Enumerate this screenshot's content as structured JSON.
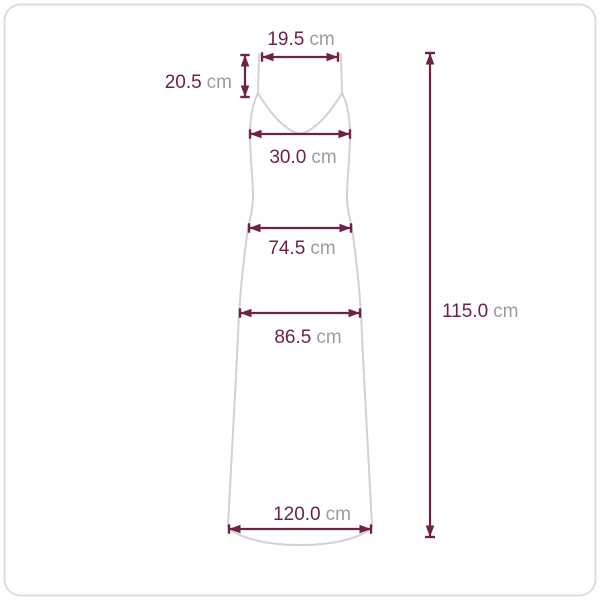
{
  "diagram": {
    "type": "garment-size-measurement",
    "garment": "sleeveless-maxi-slip-dress",
    "unit_default": "cm",
    "colors": {
      "dimension_line": "#6f2146",
      "value_text": "#6f2146",
      "unit_text": "#9c9c9c",
      "garment_outline": "#d2d2d2",
      "frame_border": "#dddddd",
      "background": "#ffffff"
    }
  },
  "measurements": [
    {
      "id": "strap-span",
      "value": "19.5",
      "unit": "cm",
      "orientation": "horizontal",
      "label_position": "above"
    },
    {
      "id": "strap-length",
      "value": "20.5",
      "unit": "cm",
      "orientation": "vertical",
      "label_position": "left"
    },
    {
      "id": "bust-width",
      "value": "30.0",
      "unit": "cm",
      "orientation": "horizontal",
      "label_position": "below"
    },
    {
      "id": "waist-width",
      "value": "74.5",
      "unit": "cm",
      "orientation": "horizontal",
      "label_position": "below"
    },
    {
      "id": "hip-width",
      "value": "86.5",
      "unit": "cm",
      "orientation": "horizontal",
      "label_position": "below"
    },
    {
      "id": "total-length",
      "value": "115.0",
      "unit": "cm",
      "orientation": "vertical",
      "label_position": "right"
    },
    {
      "id": "hem-width",
      "value": "120.0",
      "unit": "cm",
      "orientation": "horizontal",
      "label_position": "above"
    }
  ]
}
